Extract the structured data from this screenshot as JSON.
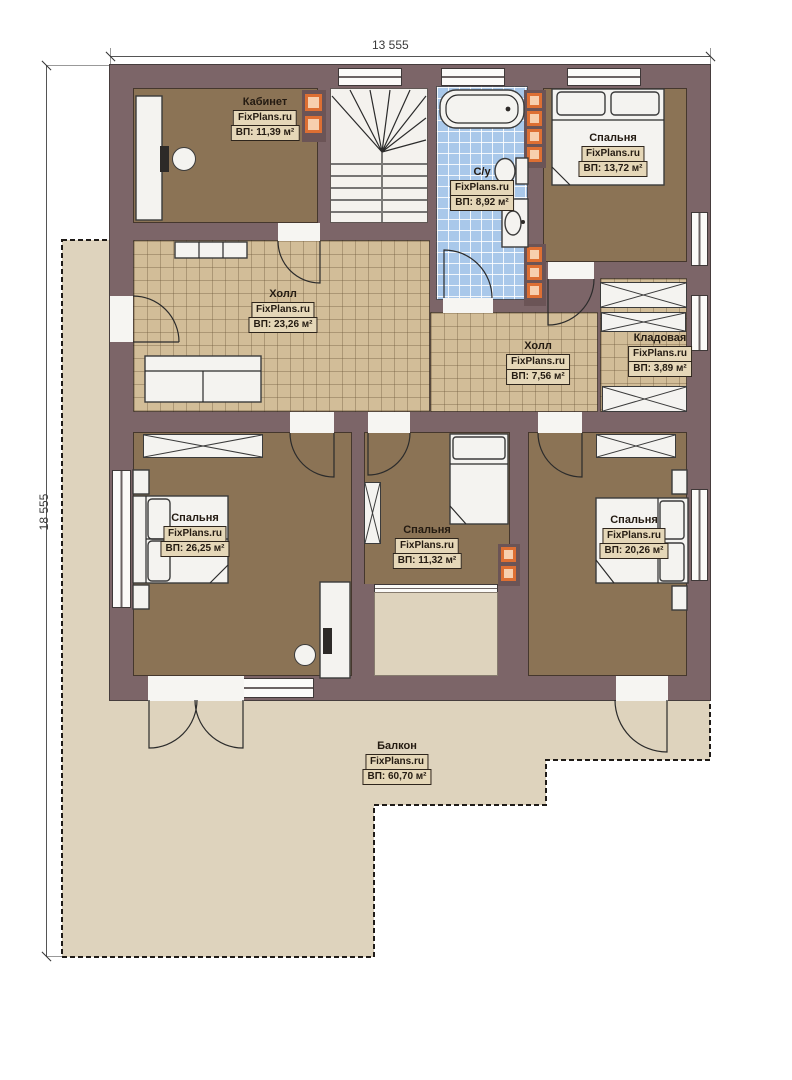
{
  "watermark": "FixPlans.ru",
  "dimensions": {
    "width_label": "13 555",
    "height_label": "18 555"
  },
  "rooms": [
    {
      "id": "office",
      "name": "Кабинет",
      "area": "ВП: 11,39 м²"
    },
    {
      "id": "bathroom",
      "name": "С/у",
      "area": "ВП: 8,92 м²"
    },
    {
      "id": "bedroom-top-right",
      "name": "Спальня",
      "area": "ВП: 13,72 м²"
    },
    {
      "id": "hall-main",
      "name": "Холл",
      "area": "ВП: 23,26 м²"
    },
    {
      "id": "hall-small",
      "name": "Холл",
      "area": "ВП: 7,56 м²"
    },
    {
      "id": "storage",
      "name": "Кладовая",
      "area": "ВП: 3,89 м²"
    },
    {
      "id": "bedroom-bottom-left",
      "name": "Спальня",
      "area": "ВП: 26,25 м²"
    },
    {
      "id": "bedroom-bottom-middle",
      "name": "Спальня",
      "area": "ВП: 11,32 м²"
    },
    {
      "id": "bedroom-bottom-right",
      "name": "Спальня",
      "area": "ВП: 20,26 м²"
    },
    {
      "id": "balcony",
      "name": "Балкон",
      "area": "ВП: 60,70 м²"
    }
  ],
  "colors": {
    "wall": "#7c6568",
    "floor-room": "#8b7355",
    "floor-tile": "#d2bd98",
    "floor-bath": "#a9c8ea",
    "floor-balcony": "#ded3bd",
    "furniture": "#f4f3f0",
    "chimney-orange": "#dd6f33",
    "chimney-light": "#f7cfae",
    "label-bg": "#e5d7b8",
    "label-border": "#2e251c",
    "dim-text": "#3a3a3a"
  }
}
